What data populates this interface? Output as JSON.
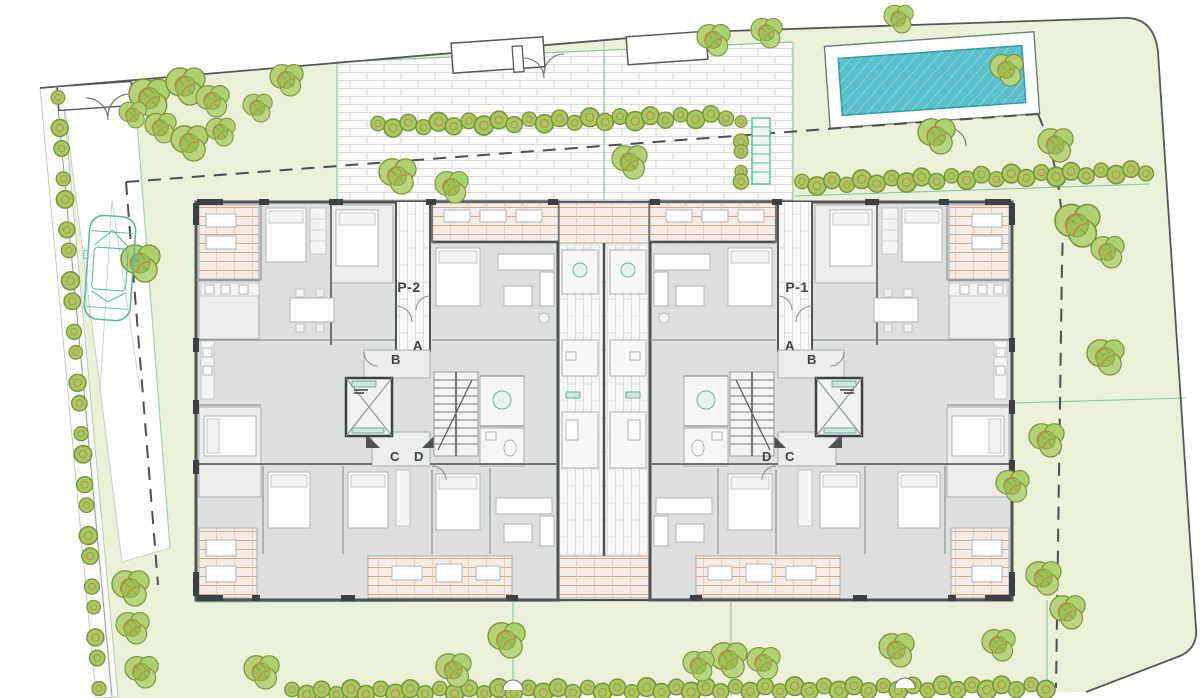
{
  "document": {
    "type": "architectural-site-plan",
    "description": "Ground floor site plan of twin apartment blocks with garden, pool, driveway and entrances"
  },
  "site": {
    "labels": [
      {
        "id": "portal-2",
        "text": "P-2",
        "x": 409,
        "y": 292,
        "size": 14,
        "weight": "bold"
      },
      {
        "id": "portal-1",
        "text": "P-1",
        "x": 797,
        "y": 292,
        "size": 14,
        "weight": "bold"
      },
      {
        "id": "unit-a-left",
        "text": "A",
        "x": 418,
        "y": 350,
        "size": 13,
        "weight": "semi"
      },
      {
        "id": "unit-b-left",
        "text": "B",
        "x": 396,
        "y": 364,
        "size": 13,
        "weight": "semi"
      },
      {
        "id": "unit-c-left",
        "text": "C",
        "x": 395,
        "y": 461,
        "size": 13,
        "weight": "semi"
      },
      {
        "id": "unit-d-left",
        "text": "D",
        "x": 419,
        "y": 461,
        "size": 13,
        "weight": "semi"
      },
      {
        "id": "unit-a-right",
        "text": "A",
        "x": 790,
        "y": 350,
        "size": 13,
        "weight": "semi"
      },
      {
        "id": "unit-b-right",
        "text": "B",
        "x": 812,
        "y": 364,
        "size": 13,
        "weight": "semi"
      },
      {
        "id": "unit-d-right",
        "text": "D",
        "x": 767,
        "y": 461,
        "size": 13,
        "weight": "semi"
      },
      {
        "id": "unit-c-right",
        "text": "C",
        "x": 790,
        "y": 461,
        "size": 13,
        "weight": "semi"
      }
    ],
    "colors": {
      "lawn": "#e9f1d8",
      "paving": "#fdfdfc",
      "paving_joint": "#d7dbd9",
      "pool_water": "#58c1ca",
      "pool_edge": "#2f99a4",
      "tree_fill": "#b5d277",
      "tree_stroke": "#7d913b",
      "tree_twig": "#c08748",
      "wall_dark": "#3d4144",
      "wall_main": "#4e5356",
      "floor_gray": "#dedfdf",
      "deck_tan": "#d3a98e",
      "accent_teal": "#57b9a6",
      "dashed_line": "#4b4f52"
    },
    "trees": [
      [
        150,
        97,
        1.05
      ],
      [
        186,
        85,
        1.0
      ],
      [
        213,
        100,
        0.85
      ],
      [
        161,
        127,
        0.8
      ],
      [
        133,
        114,
        0.7
      ],
      [
        190,
        142,
        0.95
      ],
      [
        221,
        131,
        0.75
      ],
      [
        287,
        79,
        0.85
      ],
      [
        258,
        107,
        0.75
      ],
      [
        398,
        175,
        0.95
      ],
      [
        452,
        186,
        0.85
      ],
      [
        141,
        262,
        1.0
      ],
      [
        630,
        161,
        0.9
      ],
      [
        714,
        39,
        0.85
      ],
      [
        767,
        32,
        0.8
      ],
      [
        899,
        18,
        0.75
      ],
      [
        937,
        135,
        0.95
      ],
      [
        1007,
        69,
        0.85
      ],
      [
        1056,
        144,
        0.9
      ],
      [
        1078,
        224,
        1.15
      ],
      [
        1108,
        251,
        0.85
      ],
      [
        1106,
        356,
        0.95
      ],
      [
        1047,
        439,
        0.9
      ],
      [
        1013,
        485,
        0.85
      ],
      [
        1044,
        577,
        0.9
      ],
      [
        1068,
        611,
        0.9
      ],
      [
        729,
        659,
        0.95
      ],
      [
        764,
        662,
        0.85
      ],
      [
        897,
        649,
        0.9
      ],
      [
        999,
        644,
        0.85
      ],
      [
        131,
        587,
        0.95
      ],
      [
        133,
        627,
        0.85
      ],
      [
        142,
        671,
        0.85
      ],
      [
        262,
        671,
        0.9
      ],
      [
        454,
        669,
        0.9
      ],
      [
        507,
        639,
        0.95
      ],
      [
        699,
        665,
        0.8
      ]
    ],
    "hedges": [
      {
        "id": "hedge-top-left",
        "x1": 378,
        "y1": 126,
        "x2": 726,
        "y2": 116,
        "n": 24,
        "r": 8.5
      },
      {
        "id": "hedge-top-right",
        "x1": 802,
        "y1": 184,
        "x2": 1146,
        "y2": 171,
        "n": 24,
        "r": 8.5
      },
      {
        "id": "hedge-bottom",
        "x1": 292,
        "y1": 692,
        "x2": 1046,
        "y2": 687,
        "n": 52,
        "r": 8.5
      },
      {
        "id": "hedge-left-strip",
        "x1": 58,
        "y1": 100,
        "x2": 99,
        "y2": 686,
        "n": 24,
        "r": 8
      },
      {
        "id": "hedge-stair",
        "x1": 741,
        "y1": 124,
        "x2": 741,
        "y2": 184,
        "n": 5,
        "r": 7
      }
    ],
    "pool": {
      "x": 827,
      "y": 39,
      "w": 210,
      "h": 82,
      "angle": -4
    },
    "car": {
      "x": 110,
      "y": 268,
      "angle": 4
    },
    "building": {
      "x": 196,
      "y": 202,
      "w": 816,
      "h": 398,
      "portals": [
        "P-1",
        "P-2"
      ],
      "units_per_portal": [
        "A",
        "B",
        "C",
        "D"
      ]
    }
  }
}
